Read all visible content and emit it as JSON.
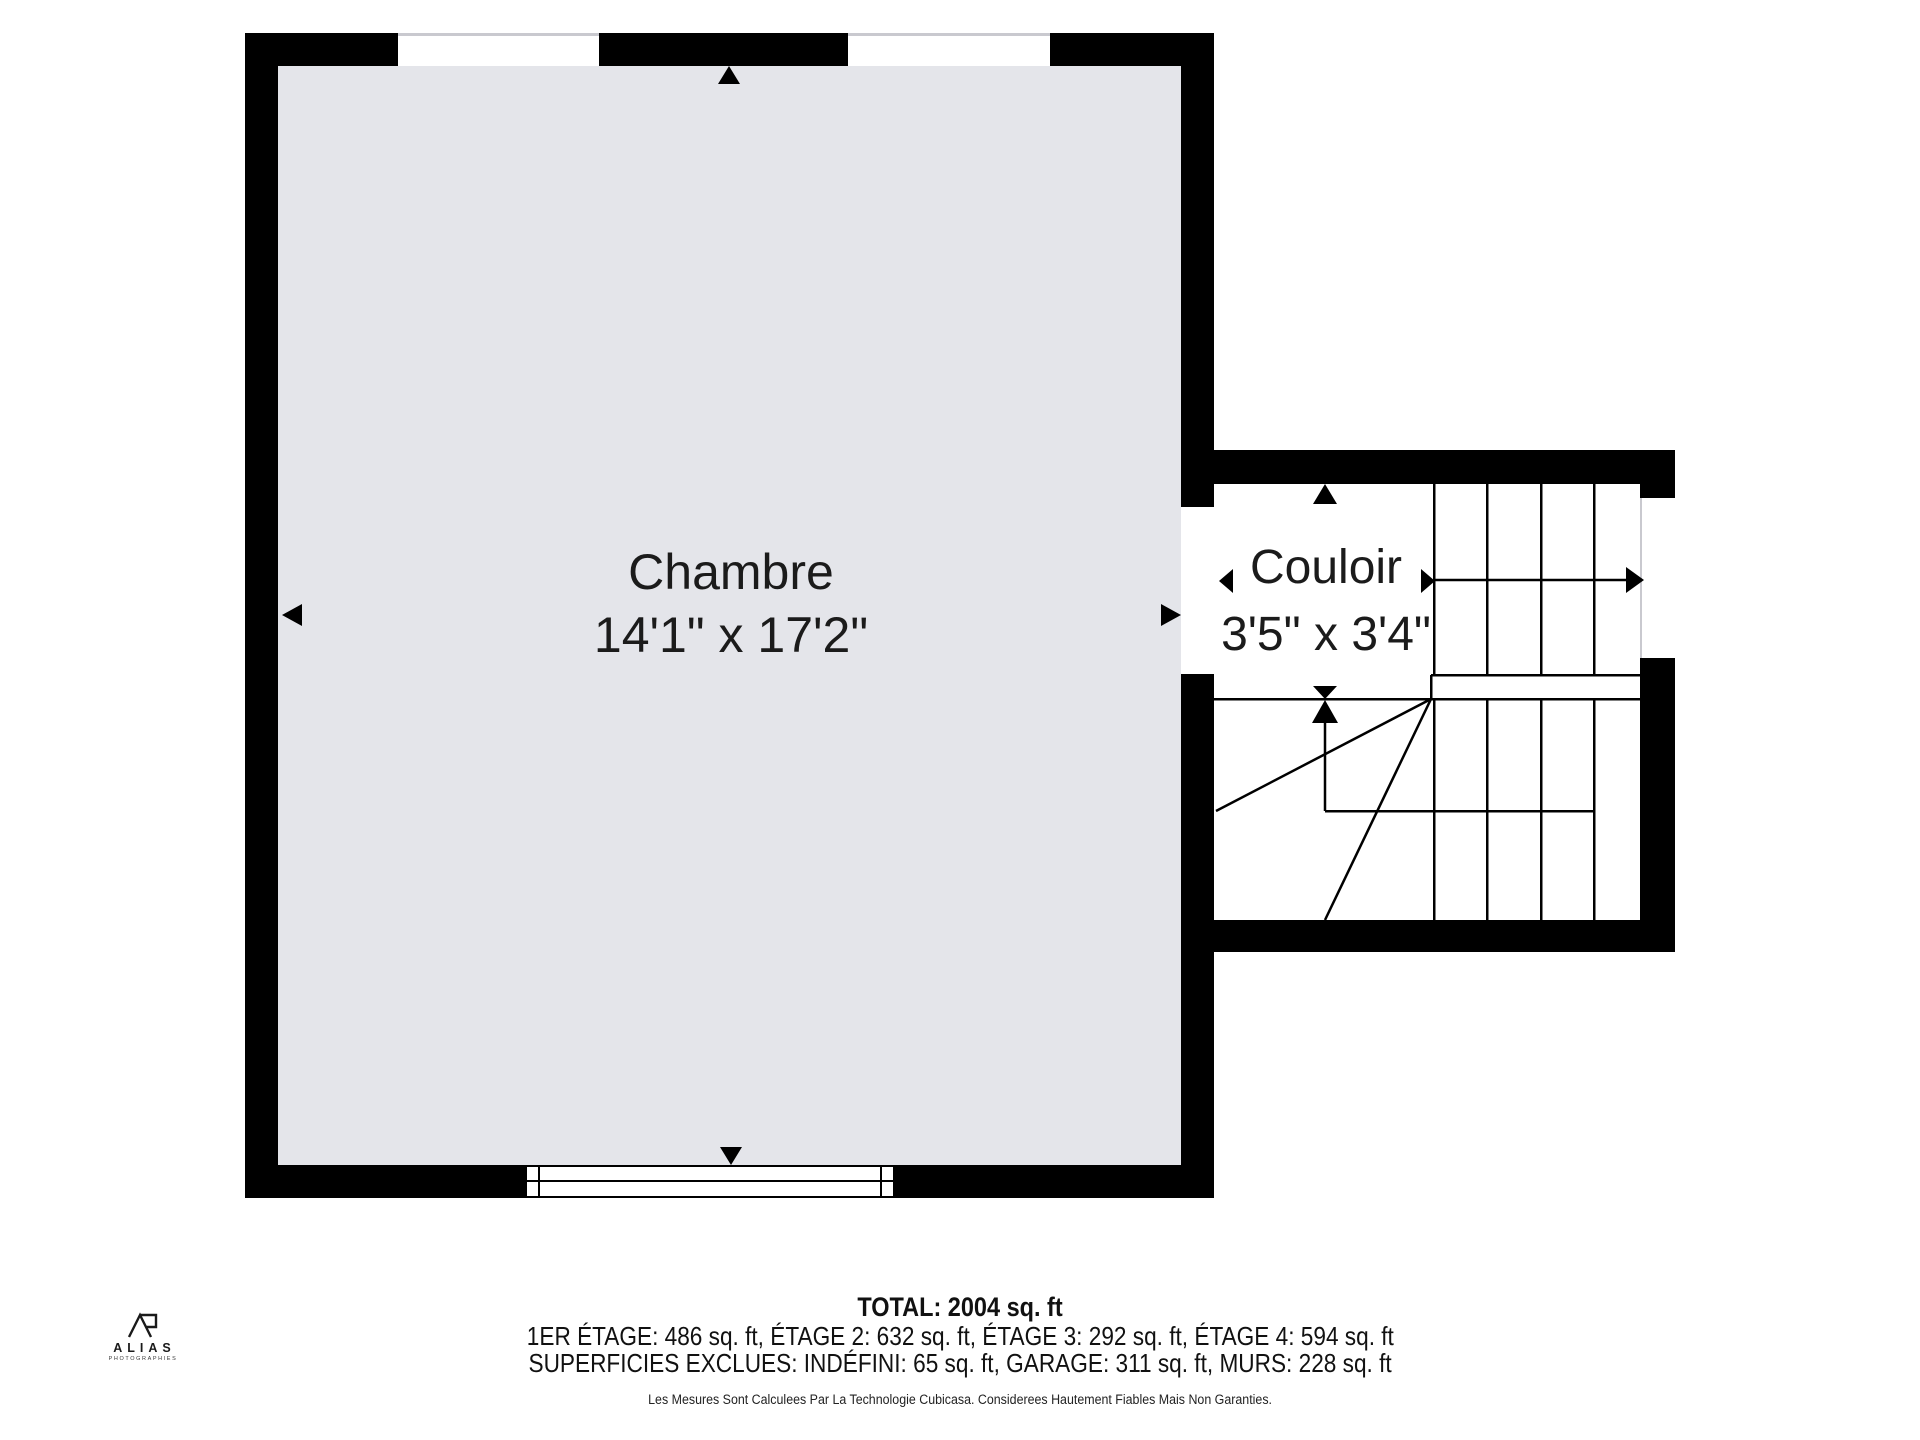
{
  "rooms": {
    "chambre": {
      "label": "Chambre",
      "dimensions": "14'1\" x 17'2\""
    },
    "couloir": {
      "label": "Couloir",
      "dimensions": "3'5\" x 3'4\""
    }
  },
  "footer": {
    "total": "TOTAL: 2004 sq. ft",
    "floor_areas": "1ER ÉTAGE: 486 sq. ft, ÉTAGE 2: 632 sq. ft, ÉTAGE 3: 292 sq. ft, ÉTAGE 4: 594 sq. ft",
    "excluded_areas": "SUPERFICIES EXCLUES: INDÉFINI: 65 sq. ft, GARAGE: 311 sq. ft, MURS: 228 sq. ft",
    "disclaimer": "Les Mesures Sont Calculees Par La Technologie Cubicasa. Considerees Hautement Fiables Mais Non Garanties."
  },
  "logo": {
    "name": "ALIAS",
    "tagline": "PHOTOGRAPHIES"
  },
  "colors": {
    "wall": "#000000",
    "room_fill": "#e4e5ea",
    "window_line": "#c9c9cf",
    "text": "#1b1b1b"
  }
}
